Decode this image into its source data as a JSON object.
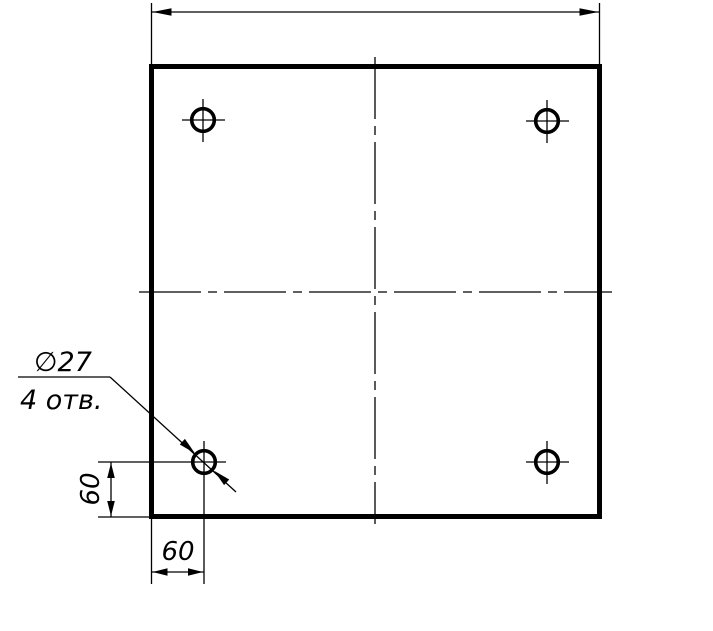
{
  "drawing": {
    "type": "engineering-drawing",
    "description": "Square plate front view with four drilled holes",
    "colors": {
      "line": "#000000",
      "background": "#ffffff"
    },
    "callout": {
      "diameter_label": "∅27",
      "count_label": "4 отв."
    },
    "dimensions": {
      "hole_offset_vertical": "60",
      "hole_offset_horizontal": "60",
      "overall_width_label": ""
    }
  }
}
